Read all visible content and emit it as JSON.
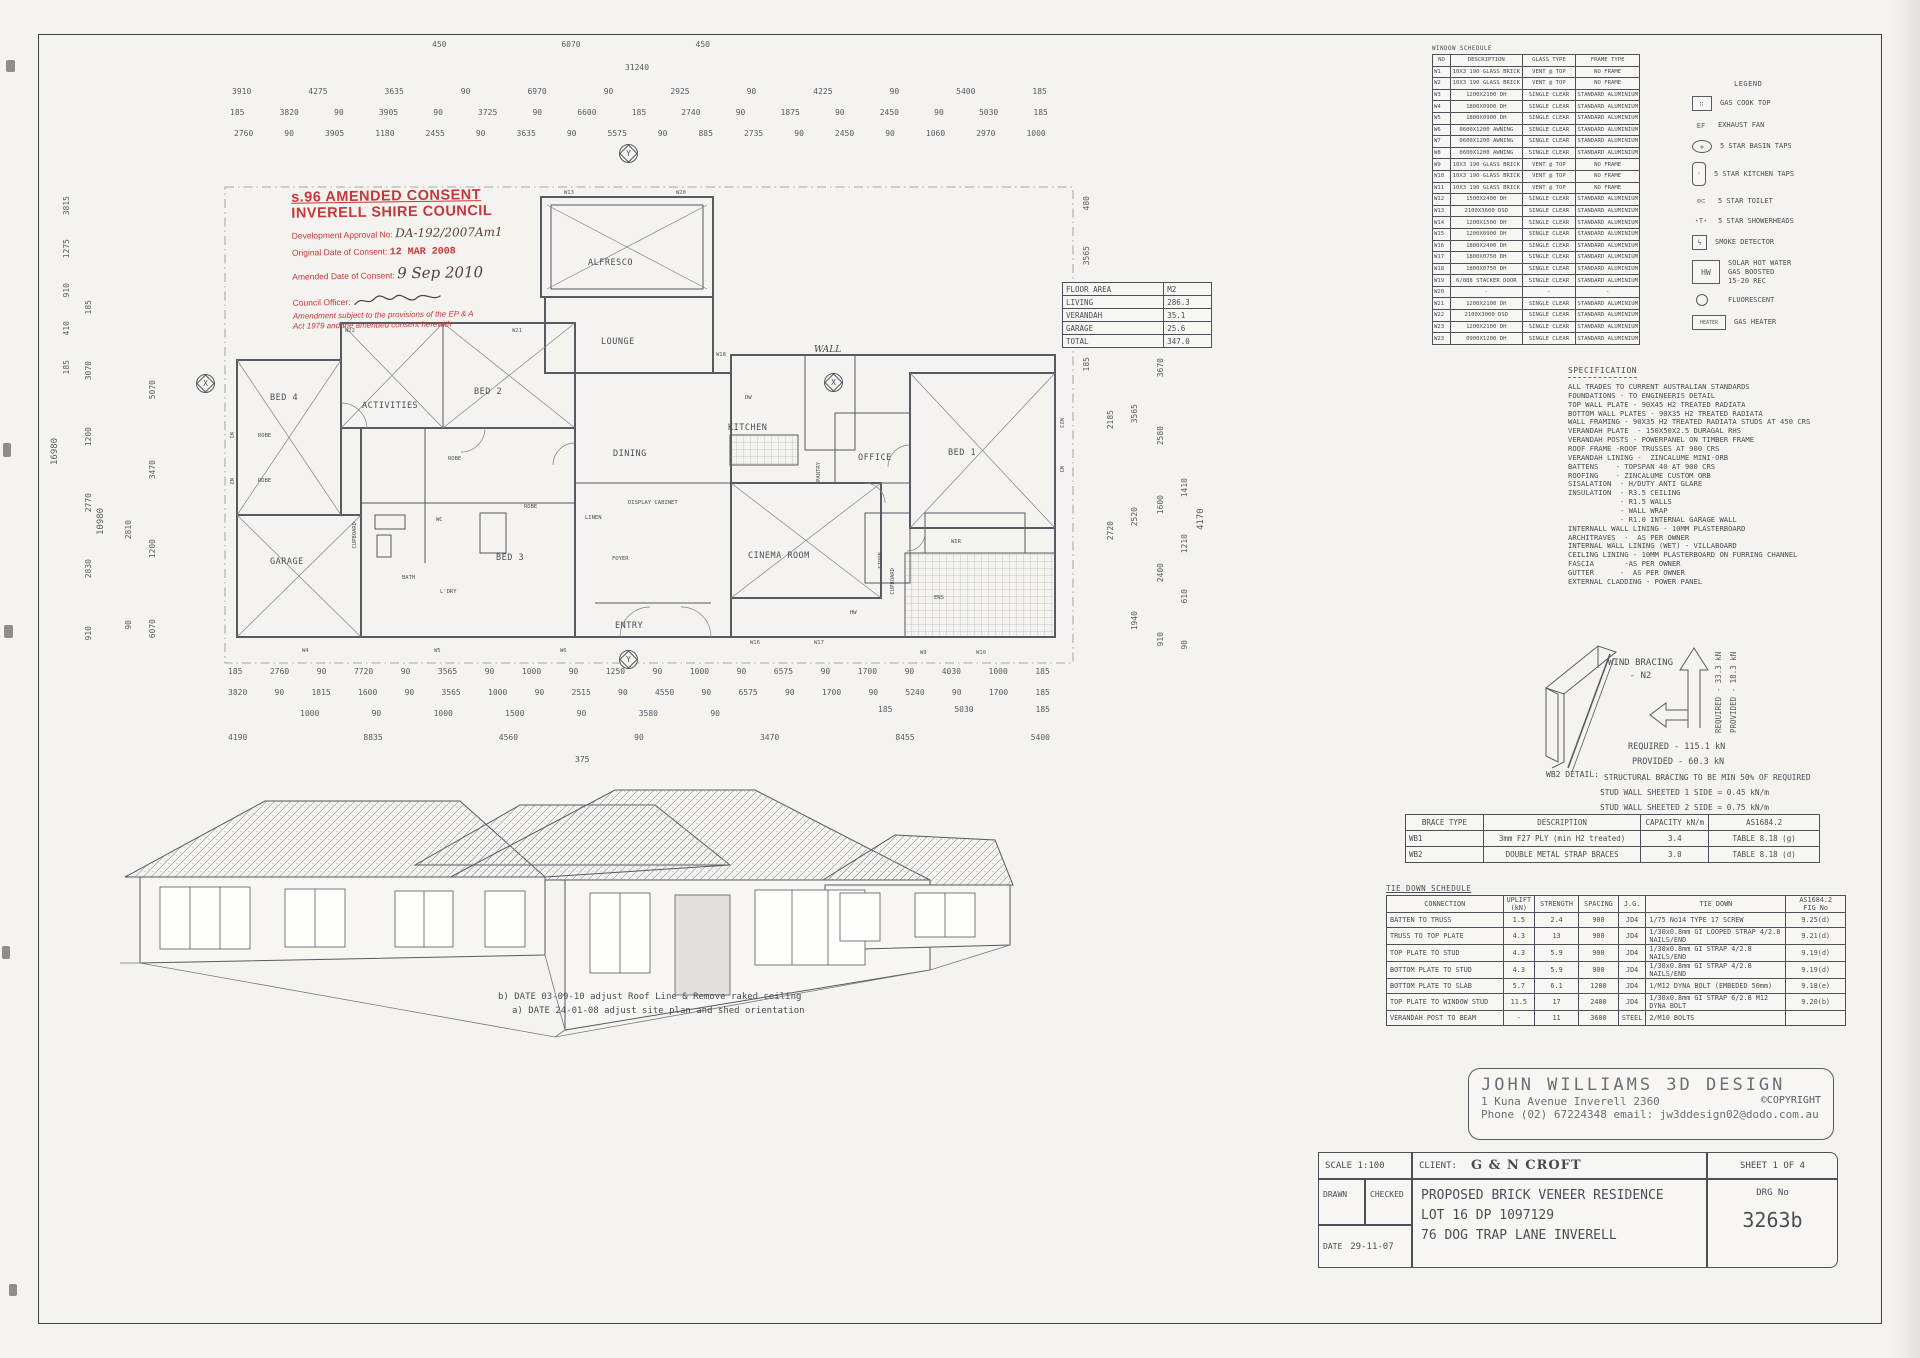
{
  "sheet": {
    "accent_red": "#c4373b",
    "ink": "#4a4e55"
  },
  "stamp": {
    "line1": "s.96 AMENDED CONSENT",
    "line2": "INVERELL SHIRE COUNCIL",
    "approval_label": "Development Approval No:",
    "approval_value": "DA-192/2007Am1",
    "original_label": "Original Date of Consent:",
    "original_value": "12 MAR 2008",
    "amended_label": "Amended Date of Consent:",
    "amended_value": "9 Sep 2010",
    "officer_label": "Council Officer:",
    "note": "Amendment subject to the provisions of the EP & A Act 1979 and the amended consent herewith"
  },
  "window_schedule": {
    "title": "WINDOW SCHEDULE",
    "headers": [
      "NO",
      "DESCRIPTION",
      "GLASS TYPE",
      "FRAME TYPE"
    ],
    "rows": [
      [
        "W1",
        "10X3 190 GLASS BRICK",
        "VENT @ TOP",
        "NO FRAME"
      ],
      [
        "W2",
        "10X3 190 GLASS BRICK",
        "VENT @ TOP",
        "NO FRAME"
      ],
      [
        "W3",
        "1200X2100 DH",
        "SINGLE CLEAR",
        "STANDARD ALUMINIUM"
      ],
      [
        "W4",
        "1800X0900 DH",
        "SINGLE CLEAR",
        "STANDARD ALUMINIUM"
      ],
      [
        "W5",
        "1800X0900 DH",
        "SINGLE CLEAR",
        "STANDARD ALUMINIUM"
      ],
      [
        "W6",
        "0600X1200 AWNING",
        "SINGLE CLEAR",
        "STANDARD ALUMINIUM"
      ],
      [
        "W7",
        "0600X1200 AWNING",
        "SINGLE CLEAR",
        "STANDARD ALUMINIUM"
      ],
      [
        "W8",
        "0600X1200 AWNING",
        "SINGLE CLEAR",
        "STANDARD ALUMINIUM"
      ],
      [
        "W9",
        "10X3 190 GLASS BRICK",
        "VENT @ TOP",
        "NO FRAME"
      ],
      [
        "W10",
        "10X3 190 GLASS BRICK",
        "VENT @ TOP",
        "NO FRAME"
      ],
      [
        "W11",
        "10X3 190 GLASS BRICK",
        "VENT @ TOP",
        "NO FRAME"
      ],
      [
        "W12",
        "1500X2400 DH",
        "SINGLE CLEAR",
        "STANDARD ALUMINIUM"
      ],
      [
        "W13",
        "2100X3600 DSD",
        "SINGLE CLEAR",
        "STANDARD ALUMINIUM"
      ],
      [
        "W14",
        "1200X1500 DH",
        "SINGLE CLEAR",
        "STANDARD ALUMINIUM"
      ],
      [
        "W15",
        "1200X0900 DH",
        "SINGLE CLEAR",
        "STANDARD ALUMINIUM"
      ],
      [
        "W16",
        "1800X2400 DH",
        "SINGLE CLEAR",
        "STANDARD ALUMINIUM"
      ],
      [
        "W17",
        "1800X0750 DH",
        "SINGLE CLEAR",
        "STANDARD ALUMINIUM"
      ],
      [
        "W18",
        "1800X0750 DH",
        "SINGLE CLEAR",
        "STANDARD ALUMINIUM"
      ],
      [
        "W19",
        "6/888 STACKER DOOR",
        "SINGLE CLEAR",
        "STANDARD ALUMINIUM"
      ],
      [
        "W20",
        "-",
        "-",
        "-"
      ],
      [
        "W21",
        "1200X2100 DH",
        "SINGLE CLEAR",
        "STANDARD ALUMINIUM"
      ],
      [
        "W22",
        "2100X3000 DSD",
        "SINGLE CLEAR",
        "STANDARD ALUMINIUM"
      ],
      [
        "W23",
        "1200X2100 DH",
        "SINGLE CLEAR",
        "STANDARD ALUMINIUM"
      ],
      [
        "W23",
        "0900X1200 DH",
        "SINGLE CLEAR",
        "STANDARD ALUMINIUM"
      ]
    ]
  },
  "legend": {
    "title": "LEGEND",
    "items": [
      "GAS COOK TOP",
      "EXHAUST FAN",
      "5 STAR BASIN TAPS",
      "5 STAR KITCHEN TAPS",
      "5 STAR TOILET",
      "5 STAR SHOWERHEADS",
      "SMOKE DETECTOR",
      "SOLAR HOT WATER\nGAS BOOSTED\n15-20 REC",
      "FLUORESCENT",
      "GAS HEATER"
    ],
    "hw_label": "HW",
    "heater_label": "HEATER"
  },
  "specification": {
    "title": "SPECIFICATION",
    "lines": [
      "ALL TRADES TO CURRENT AUSTRALIAN STANDARDS",
      "FOUNDATIONS - TO ENGINEERIS DETAIL",
      "TOP WALL PLATE - 90X45 H2 TREATED RADIATA",
      "BOTTOM WALL PLATES - 90X35 H2 TREATED RADIATA",
      "WALL FRAMING - 90X35 H2 TREATED RADIATA STUDS AT 450 CRS",
      "VERANDAH PLATE  - 150X50X2.5 DURAGAL RHS",
      "VERANDAH POSTS - POWERPANEL ON TIMBER FRAME",
      "ROOF FRAME -ROOF TRUSSES AT 900 CRS",
      "VERANDAH LINING -  ZINCALUME MINI-ORB",
      "BATTENS    - TOPSPAN 40 AT 900 CRS",
      "ROOFING    - ZINCALUME CUSTOM ORB",
      "SISALATION  - H/DUTY ANTI GLARE",
      "INSULATION  - R3.5 CEILING",
      "            - R1.5 WALLS",
      "            - WALL WRAP",
      "            - R1.0 INTERNAL GARAGE WALL",
      "INTERNALL WALL LINING - 10MM PLASTERBOARD",
      "ARCHITRAVES  -  AS PER OWNER",
      "INTERNAL WALL LINING (WET) - VILLABOARD",
      "CEILING LINING - 10MM PLASTERBOARD ON FURRING CHANNEL",
      "FASCIA       -AS PER OWNER",
      "GUTTER      -  AS PER OWNER",
      "EXTERNAL CLADDING - POWER PANEL"
    ]
  },
  "floor_area": {
    "headers": [
      "FLOOR AREA",
      "M2"
    ],
    "rows": [
      [
        "LIVING",
        "286.3"
      ],
      [
        "VERANDAH",
        "35.1"
      ],
      [
        "GARAGE",
        "25.6"
      ],
      [
        "TOTAL",
        "347.0"
      ]
    ]
  },
  "wind_bracing": {
    "title_line1": "WIND BRACING",
    "title_line2": "- N2",
    "vertical_required": "REQUIRED - 33.3 kN",
    "vertical_provided": "PROVIDED - 18.3 kN",
    "required": "REQUIRED - 115.1 kN",
    "provided": "PROVIDED - 60.3 kN",
    "note1": "STRUCTURAL BRACING TO BE MIN 50% OF REQUIRED",
    "note2": "STUD WALL SHEETED 1 SIDE = 0.45 kN/m",
    "note3": "STUD WALL SHEETED 2 SIDE = 0.75 kN/m",
    "detail_label": "WB2  DETAIL:"
  },
  "brace_table": {
    "headers": [
      "BRACE TYPE",
      "DESCRIPTION",
      "CAPACITY kN/m",
      "AS1684.2"
    ],
    "rows": [
      [
        "WB1",
        "3mm F27 PLY (min H2 treated)",
        "3.4",
        "TABLE 8.18 (g)"
      ],
      [
        "WB2",
        "DOUBLE METAL STRAP BRACES",
        "3.0",
        "TABLE 8.18 (d)"
      ]
    ]
  },
  "tie_down": {
    "title": "TIE DOWN SCHEDULE",
    "headers": [
      "CONNECTION",
      "UPLIFT\n(kN)",
      "STRENGTH",
      "SPACING",
      "J.G.",
      "TIE DOWN",
      "AS1684.2\nFIG No"
    ],
    "rows": [
      [
        "BATTEN TO TRUSS",
        "1.5",
        "2.4",
        "900",
        "JD4",
        "1/75 No14 TYPE 17 SCREW",
        "9.25(d)"
      ],
      [
        "TRUSS TO TOP PLATE",
        "4.3",
        "13",
        "900",
        "JD4",
        "1/30x0.8mm GI LOOPED STRAP 4/2.8 NAILS/END",
        "9.21(d)"
      ],
      [
        "TOP PLATE TO STUD",
        "4.3",
        "5.9",
        "900",
        "JD4",
        "1/30x0.8mm GI STRAP 4/2.8 NAILS/END",
        "9.19(d)"
      ],
      [
        "BOTTOM PLATE TO STUD",
        "4.3",
        "5.9",
        "900",
        "JD4",
        "1/30x0.8mm GI STRAP 4/2.8 NAILS/END",
        "9.19(d)"
      ],
      [
        "BOTTOM PLATE TO SLAB",
        "5.7",
        "6.1",
        "1200",
        "JD4",
        "1/M12 DYNA BOLT (EMBEDED 50mm)",
        "9.18(e)"
      ],
      [
        "TOP PLATE TO WINDOW STUD",
        "11.5",
        "17",
        "2400",
        "JD4",
        "1/30x0.8mm GI STRAP 6/2.8 M12 DYNA BOLT",
        "9.20(b)"
      ],
      [
        "VERANDAH POST TO BEAM",
        "-",
        "11",
        "3600",
        "STEEL",
        "2/M10 BOLTS",
        ""
      ]
    ]
  },
  "plan": {
    "rooms": {
      "alfresco": "ALFRESCO",
      "lounge": "LOUNGE",
      "bed4": "BED 4",
      "activities": "ACTIVITIES",
      "bed2": "BED 2",
      "kitchen": "KITCHEN",
      "dining": "DINING",
      "bed3": "BED 3",
      "garage": "GARAGE",
      "foyer": "FOYER",
      "entry": "ENTRY",
      "cinema": "CINEMA ROOM",
      "office": "OFFICE",
      "pantry": "PANTRY",
      "bed1": "BED 1",
      "wir": "WIR",
      "store": "STORE",
      "ens": "ENS",
      "display_cabinet": "DISPLAY CABINET"
    },
    "fixtures": {
      "robe": "ROBE",
      "wc": "WC",
      "bath": "BATH",
      "ldry": "L'DRY",
      "hw": "HW",
      "cupboard": "CUPBOARD",
      "linen": "LINEN",
      "dw": "DW"
    },
    "annotations": {
      "wall": "WALL"
    },
    "axis": {
      "x": "X",
      "y": "Y"
    },
    "window_tags": [
      "W1",
      "W2",
      "W3",
      "W4",
      "W5",
      "W6",
      "W9",
      "W10",
      "W13",
      "W16",
      "W17",
      "W18",
      "W20",
      "W21",
      "W22",
      "W23"
    ]
  },
  "dimensions": {
    "top_r1": [
      "450",
      "6070",
      "450"
    ],
    "top_r2": [
      "31240"
    ],
    "top_r3": [
      "3910",
      "4275",
      "3635",
      "90",
      "6970",
      "90",
      "2925",
      "90",
      "4225",
      "90",
      "5400",
      "185"
    ],
    "top_r4": [
      "185",
      "3820",
      "90",
      "3905",
      "90",
      "3725",
      "90",
      "6600",
      "185",
      "2740",
      "90",
      "1875",
      "90",
      "2450",
      "90",
      "5030",
      "185"
    ],
    "top_r5": [
      "2760",
      "90",
      "3905",
      "1180",
      "2455",
      "90",
      "3635",
      "90",
      "5575",
      "90",
      "885",
      "2735",
      "90",
      "2450",
      "90",
      "1060",
      "2970",
      "1000"
    ],
    "bot_r1": [
      "185",
      "2760",
      "90",
      "7720",
      "90",
      "3565",
      "90",
      "1000",
      "90",
      "1250",
      "90",
      "1000",
      "90",
      "6575",
      "90",
      "1700",
      "90",
      "4030",
      "1000",
      "185"
    ],
    "bot_r2": [
      "3820",
      "90",
      "1815",
      "1600",
      "90",
      "3565",
      "1000",
      "90",
      "2515",
      "90",
      "4550",
      "90",
      "6575",
      "90",
      "1700",
      "90",
      "5240",
      "90",
      "1700",
      "185"
    ],
    "bot_r3": [
      "1000",
      "90",
      "1000",
      "1500",
      "90",
      "3580",
      "90"
    ],
    "bot_r3b": [
      "185",
      "5030",
      "185"
    ],
    "bot_r4": [
      "4190",
      "8835",
      "4560",
      "90",
      "3470",
      "8455",
      "5400"
    ],
    "bot_single": "375",
    "left_c1": [
      "3815",
      "1275",
      "910",
      "410",
      "185"
    ],
    "left_big1": "16980",
    "left_big2": "10980",
    "left_c3": [
      "185",
      "3070",
      "1200",
      "2770",
      "2830",
      "910"
    ],
    "left_c4": [
      "5070",
      "3470",
      "1200",
      "6070"
    ],
    "left_c5": [
      "2810",
      "90"
    ],
    "right_c1": [
      "480",
      "3565",
      "2000",
      "185"
    ],
    "right_c2": [
      "3815",
      "2185",
      "2720"
    ],
    "right_c3": [
      "6055",
      "3565",
      "2520",
      "1940"
    ],
    "right_c4": [
      "3670",
      "2580",
      "1600",
      "2400",
      "910"
    ],
    "right_c5": [
      "1410",
      "1210",
      "610",
      "90"
    ],
    "right_single": "4170"
  },
  "notes": {
    "b": "b) DATE 03-09-10 adjust Roof Line & Remove raked ceiling",
    "a": "a) DATE 24-01-08 adjust site plan and shed orientation"
  },
  "designer": {
    "name": "JOHN WILLIAMS 3D DESIGN",
    "address": "1 Kuna Avenue Inverell 2360",
    "copyright": "©COPYRIGHT",
    "contact": "Phone (02) 67224348 email: jw3ddesign02@dodo.com.au"
  },
  "title_block": {
    "scale": "SCALE 1:100",
    "client_label": "CLIENT:",
    "client": "G & N CROFT",
    "sheet": "SHEET 1 OF 4",
    "drawn": "DRAWN",
    "checked": "CHECKED",
    "date_label": "DATE",
    "date": "29-11-07",
    "project_line1": "PROPOSED BRICK VENEER RESIDENCE",
    "project_line2": "LOT 16 DP 1097129",
    "project_line3": "76 DOG TRAP LANE INVERELL",
    "drg_label": "DRG No",
    "drg_no": "3263b"
  }
}
